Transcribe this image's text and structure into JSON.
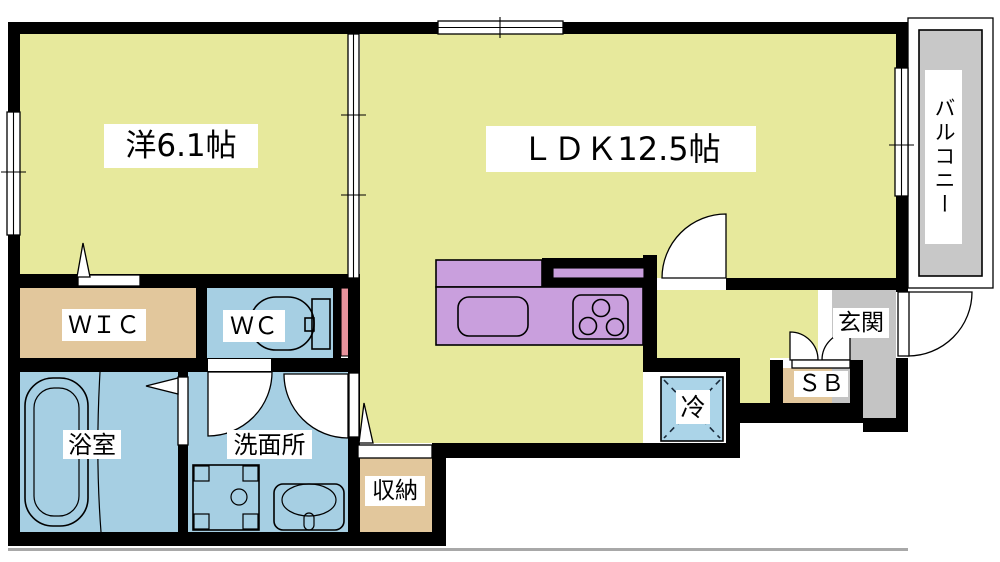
{
  "colors": {
    "wall": "#000000",
    "room_yellow": "#e7e99c",
    "closet_tan": "#e2c79c",
    "wet_blue": "#a6cfe3",
    "kitchen_purple": "#c99fdd",
    "balcony_gray": "#c8c8c8",
    "entrance_gray": "#c4c4c4",
    "pipe_pink": "#e8939c",
    "fridge_blue": "#abd4e8",
    "shadow_gray": "#a8a8a8"
  },
  "rooms": {
    "western": {
      "label": "洋6.1帖"
    },
    "ldk": {
      "label": "ＬＤＫ12.5帖"
    },
    "balcony": {
      "label": "バルコニー"
    },
    "wic": {
      "label": "ＷＩＣ"
    },
    "wc": {
      "label": "ＷＣ"
    },
    "bathroom": {
      "label": "浴室"
    },
    "washroom": {
      "label": "洗面所"
    },
    "storage": {
      "label": "収納"
    },
    "refrigerator": {
      "label": "冷"
    },
    "entrance": {
      "label": "玄関"
    },
    "shoebox": {
      "label": "ＳＢ"
    }
  },
  "icons": {
    "toilet": "toilet-icon",
    "bathtub": "bathtub-icon",
    "washing_machine": "washing-machine-icon",
    "basin": "basin-icon",
    "kitchen_sink": "kitchen-sink-icon",
    "stove": "stove-icon",
    "refrigerator": "refrigerator-cross-icon",
    "door_swing": "door-swing-icon",
    "sliding_door": "sliding-door-icon",
    "window": "window-icon"
  }
}
